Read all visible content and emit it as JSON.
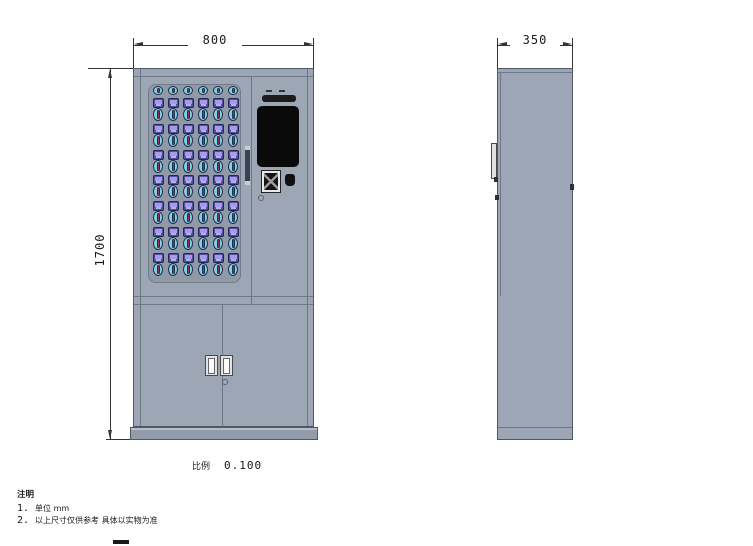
{
  "drawing": {
    "type": "cabinet technical drawing, front and side orthographic views",
    "dimensions": {
      "front_width": "800",
      "front_height": "1700",
      "side_depth": "350"
    },
    "scale": {
      "label": "比例",
      "value": "0.100"
    },
    "notes": {
      "title": "注明",
      "items": [
        {
          "num": "1.",
          "text": "单位 mm"
        },
        {
          "num": "2.",
          "text": "以上尺寸仅供参考  具体以实物为准"
        }
      ]
    }
  },
  "key_grid": {
    "rows": 7,
    "cols": 6,
    "top_row_heads": 6
  },
  "icons": [
    "speaker-grille-icon",
    "touchscreen",
    "qr-scanner-icon",
    "camera-icon",
    "keyhole-icon",
    "door-handle",
    "key-fob-slot",
    "key-head"
  ],
  "colors": {
    "dim": "#333333",
    "cabinet": "#9ca6b4",
    "cabinet-border": "#4f5864",
    "seam": "#6f7886",
    "panel": "#8f99a7",
    "panel-border": "#727b8a",
    "base": "#929cab",
    "key-square": "#544ea6",
    "key-square-border": "#26264e",
    "key-square-inner": "#a49bec",
    "key-oval": "#7fd2e2",
    "key-oval-border": "#1e2a4a",
    "key-slot": "#20304e",
    "key-slot-line": "#93305a",
    "screen": "#0a0a0a"
  }
}
